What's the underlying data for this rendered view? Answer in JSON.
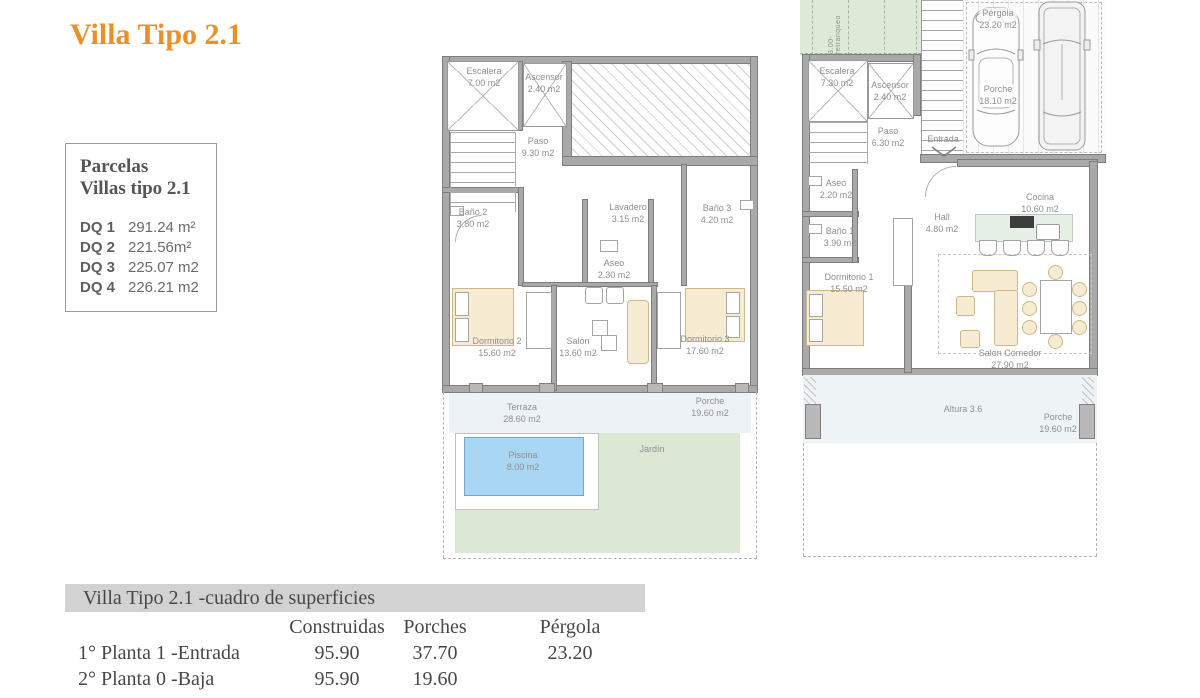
{
  "title": "Villa Tipo 2.1",
  "parcelas": {
    "heading1": "Parcelas",
    "heading2": "Villas tipo 2.1",
    "rows": [
      {
        "label": "DQ 1",
        "value": "291.24 m²"
      },
      {
        "label": "DQ 2",
        "value": "221.56m²"
      },
      {
        "label": "DQ 3",
        "value": "225.07 m2"
      },
      {
        "label": "DQ 4",
        "value": "226.21 m2"
      }
    ]
  },
  "plan_upper": {
    "escalera": {
      "name": "Escalera",
      "area": "7.00 m2"
    },
    "ascensor": {
      "name": "Ascensor",
      "area": "2.40 m2"
    },
    "paso": {
      "name": "Paso",
      "area": "9.30 m2"
    },
    "bano2": {
      "name": "Baño 2",
      "area": "3.80 m2"
    },
    "lavadero": {
      "name": "Lavadero",
      "area": "3.15 m2"
    },
    "bano3": {
      "name": "Baño 3",
      "area": "4.20 m2"
    },
    "aseo": {
      "name": "Aseo",
      "area": "2.30 m2"
    },
    "dormitorio2": {
      "name": "Dormitorio 2",
      "area": "15.60 m2"
    },
    "salon": {
      "name": "Salón",
      "area": "13.60 m2"
    },
    "dormitorio3": {
      "name": "Dormitorio 3",
      "area": "17.60 m2"
    },
    "terraza": {
      "name": "Terraza",
      "area": "28.60 m2"
    },
    "porche": {
      "name": "Porche",
      "area": "19.60 m2"
    },
    "piscina": {
      "name": "Piscina",
      "area": "8.00 m2"
    },
    "jardin": {
      "name": "Jardín"
    }
  },
  "plan_lower": {
    "retranqueo": "3.00-retranqueo",
    "pergola": {
      "name": "Pérgola",
      "area": "23.20 m2"
    },
    "escalera": {
      "name": "Escalera",
      "area": "7.30 m2"
    },
    "ascensor": {
      "name": "Ascensor",
      "area": "2.40 m2"
    },
    "porche_garaje": {
      "name": "Porche",
      "area": "18.10 m2"
    },
    "paso": {
      "name": "Paso",
      "area": "6.30 m2"
    },
    "entrada": {
      "name": "Entrada"
    },
    "aseo": {
      "name": "Aseo",
      "area": "2.20 m2"
    },
    "bano1": {
      "name": "Baño 1",
      "area": "3.90 m2"
    },
    "hall": {
      "name": "Hall",
      "area": "4.80 m2"
    },
    "cocina": {
      "name": "Cocina",
      "area": "10.60 m2"
    },
    "dormitorio1": {
      "name": "Dormitorio 1",
      "area": "15.50 m2"
    },
    "salon_comedor": {
      "name": "Salon Comedor",
      "area": "27.90 m2"
    },
    "altura": {
      "name": "Altura 3.6"
    },
    "porche_trasero": {
      "name": "Porche",
      "area": "19.60 m2"
    }
  },
  "surface_table": {
    "header": "Villa Tipo 2.1 -cuadro de superficies",
    "columns": [
      "Construidas",
      "Porches",
      "Pérgola"
    ],
    "rows": [
      {
        "label": "1° Planta 1 -Entrada",
        "construidas": "95.90",
        "porches": "37.70",
        "pergola": "23.20"
      },
      {
        "label": "2° Planta 0 -Baja",
        "construidas": "95.90",
        "porches": "19.60",
        "pergola": ""
      }
    ]
  },
  "colors": {
    "accent": "#E8912B",
    "wall": "#a9a9a9",
    "garden_green": "#dce8d4",
    "pool_blue": "#a9d6f2",
    "furniture_beige": "#f7ecd2",
    "terrace_band": "#edf2f6",
    "table_header_bg": "#d2d2d2"
  }
}
